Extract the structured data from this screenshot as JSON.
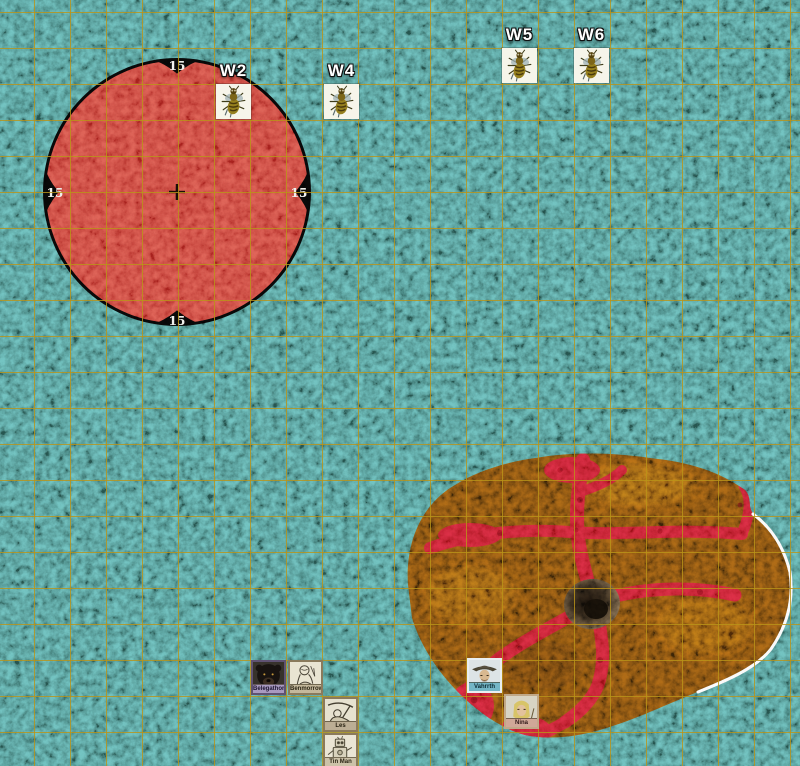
{
  "map": {
    "width": 800,
    "height": 766,
    "grid_size": 36,
    "grid_offset_x": 34,
    "grid_offset_y": 12,
    "grid_color": "#ba9418",
    "bg_color": "#4e8f8b",
    "token_size": 35
  },
  "spell_template": {
    "radius_label": "15",
    "center_x": 177,
    "center_y": 192,
    "radius": 134,
    "ring_color": "#070707",
    "fill_color": "#c8443c"
  },
  "terrain": {
    "name": "lava mound with pit",
    "base_color": "#77490f",
    "vein_color": "#c22030",
    "edge_color": "#ffffff",
    "hole_center_x": 592,
    "hole_center_y": 604
  },
  "wasp_tokens": [
    {
      "id": "W2",
      "x": 216,
      "y": 84
    },
    {
      "id": "W4",
      "x": 324,
      "y": 84
    },
    {
      "id": "W5",
      "x": 502,
      "y": 48
    },
    {
      "id": "W6",
      "x": 574,
      "y": 48
    }
  ],
  "character_tokens": [
    {
      "name": "Belegathor",
      "x": 251,
      "y": 660,
      "portrait": "bear",
      "frame": "#5f5272",
      "plate_bg": "#a89ac0",
      "plate_color": "#1c1430"
    },
    {
      "name": "Benmorrow",
      "x": 288,
      "y": 660,
      "portrait": "sketch",
      "frame": "#8a7a5c",
      "plate_bg": "#c4b89c",
      "plate_color": "#2a2414"
    },
    {
      "name": "Les",
      "x": 323,
      "y": 697,
      "portrait": "scythe",
      "frame": "#8a7a5c",
      "plate_bg": "#bcae94",
      "plate_color": "#2a2414"
    },
    {
      "name": "Tin Man",
      "x": 323,
      "y": 733,
      "portrait": "tinman",
      "frame": "#8a7a5c",
      "plate_bg": "#ccc2a8",
      "plate_color": "#2a2414"
    },
    {
      "name": "Vahrrth",
      "x": 467,
      "y": 658,
      "portrait": "hat",
      "frame": "#e9eef0",
      "plate_bg": "#74b6c6",
      "plate_color": "#0c2830"
    },
    {
      "name": "Nina",
      "x": 504,
      "y": 694,
      "portrait": "elf",
      "frame": "#c0a888",
      "plate_bg": "#d0a898",
      "plate_color": "#301818"
    }
  ]
}
